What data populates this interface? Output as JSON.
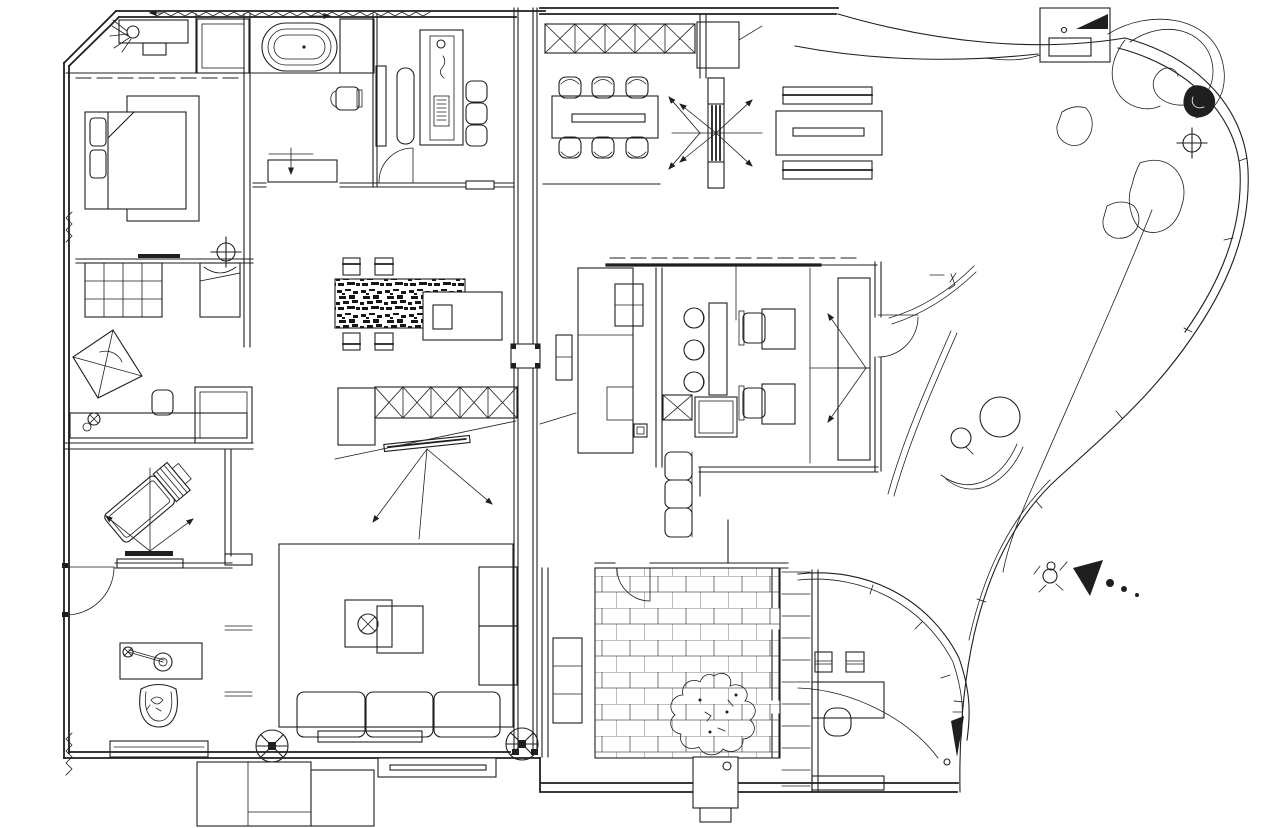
{
  "document": {
    "title": "Residential apartment floor plan - black and white CAD line drawing",
    "drawing_type": "architectural plan view",
    "text_content": "none (drawing contains no legible text labels)"
  },
  "canvas": {
    "width": 1280,
    "height": 828,
    "background": "#ffffff",
    "line": "#1f1f1f"
  },
  "rooms": [
    {
      "id": "master-bedroom",
      "label": "Master bedroom with double bed, pillows and rug"
    },
    {
      "id": "bathroom",
      "label": "Bathroom with shower, oval bathtub, toilet and vanity cabinet"
    },
    {
      "id": "dressing-study",
      "label": "Dressing / study room with long desk, three chairs and bench"
    },
    {
      "id": "bedroom-2",
      "label": "Second bedroom with cubby shelf, single bed, kite rug and desk"
    },
    {
      "id": "media-room",
      "label": "Media room with tilted recliner, TV and projection arrows"
    },
    {
      "id": "lounge",
      "label": "Lounge with record-player table, basket chair and console"
    },
    {
      "id": "living-room",
      "label": "Living room with rug, coffee tables, three-seat sofa and chaise"
    },
    {
      "id": "tea-corner",
      "label": "Tea corner with stone-textured table, four floor stools and X-cabinets"
    },
    {
      "id": "dining-room",
      "label": "Dining room with six chairs, table and X-pattern closet row"
    },
    {
      "id": "kitchen",
      "label": "Kitchen island block with sink unit"
    },
    {
      "id": "guest-bedroom-office",
      "label": "Guest bedroom / office with bar counter, stools, two workstations and wardrobe"
    },
    {
      "id": "entry-hall",
      "label": "Entry hall with pivot door, bench-table set and entry bench"
    },
    {
      "id": "courtyard-patio",
      "label": "Brick-paved courtyard with tree, bench and planter"
    },
    {
      "id": "curved-den",
      "label": "Curved-glass den with desk, chair and shelf wall"
    },
    {
      "id": "terrace-garden",
      "label": "Free-form terrace garden with round table, stones, spiral feature and BBQ box"
    }
  ],
  "symbols": [
    {
      "name": "ceiling-fan-symbol",
      "glyph": "circle with X and center square"
    },
    {
      "name": "survey-point-symbol",
      "glyph": "crosshair circle"
    },
    {
      "name": "door-swing-symbol",
      "glyph": "quarter arc with leaf line"
    },
    {
      "name": "pivot-door-symbol",
      "glyph": "radiating arrows around vertical door core"
    },
    {
      "name": "entry-direction-symbol",
      "glyph": "walking person figure, solid cone arrow and trailing dots"
    },
    {
      "name": "north-arrow-fill",
      "glyph": "solid black triangle in equipment box"
    }
  ],
  "patterns": [
    {
      "name": "brick-paving",
      "area": "courtyard floor",
      "unit": "running bond 28x16"
    },
    {
      "name": "stone-texture",
      "area": "tea table top",
      "unit": "random black speckle"
    }
  ]
}
